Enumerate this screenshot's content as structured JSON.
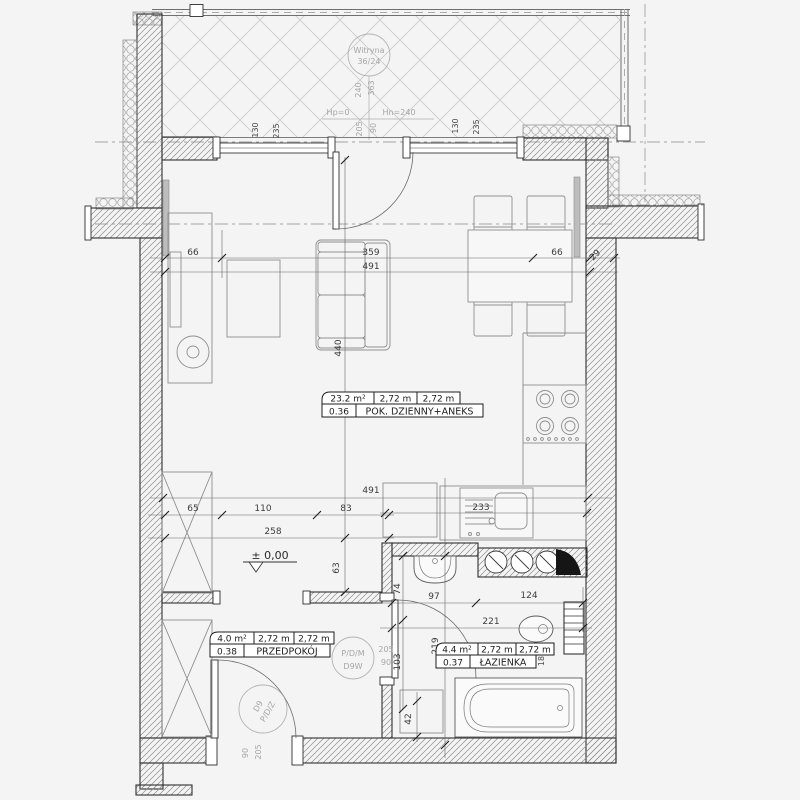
{
  "plan_type": "apartment-floor-plan",
  "balcony": {
    "glazing_label": "Witryna",
    "glazing_size": "36/24",
    "dim_240": "240",
    "dim_363": "363",
    "hp_label": "Hp=0",
    "hn_label": "Hn=240",
    "door_height": "205",
    "door_width": "90",
    "window1_dim_a": "130",
    "window1_dim_b": "235",
    "window2_dim_a": "130",
    "window2_dim_b": "235"
  },
  "rooms": {
    "living": {
      "number": "0.36",
      "name": "POK. DZIENNY+ANEKS",
      "area": "23.2 m²",
      "dim_w": "2,72 m",
      "dim_h": "2,72 m"
    },
    "hallway": {
      "number": "0.38",
      "name": "PRZEDPOKÓJ",
      "area": "4.0 m²",
      "dim_w": "2,72 m",
      "dim_h": "2,72 m"
    },
    "bathroom": {
      "number": "0.37",
      "name": "ŁAZIENKA",
      "area": "4.4 m²",
      "dim_w": "2,72 m",
      "dim_h": "2,72 m",
      "side_note": "18"
    }
  },
  "dims": {
    "top_left_66": "66",
    "top_359": "359",
    "top_right_66": "66",
    "top_29": "29",
    "top_total_491": "491",
    "depth_440": "440",
    "passage_63": "63",
    "low_65": "65",
    "low_110": "110",
    "low_83": "83",
    "low_total_258": "258",
    "kitchen_491": "491",
    "sink_233": "233",
    "bath_74": "74",
    "bath_97": "97",
    "bath_124": "124",
    "bath_221": "221",
    "bath_219": "219",
    "bath_103": "103",
    "bath_42": "42",
    "level": "± 0,00"
  },
  "doors": {
    "entrance_code": "D9",
    "entrance_type": "P/D/Z",
    "entrance_w": "90",
    "entrance_h": "205",
    "bath_type": "P/D/M",
    "bath_code": "D9W",
    "bath_w": "90",
    "bath_h": "205"
  },
  "colors": {
    "wall_line": "#2f2f2f",
    "hatch": "#9a9a9a",
    "balcony_hatch": "#c9c9c9",
    "dim_text": "#3c3c3c",
    "gray_note": "#a6a6a6",
    "radiator": "#bdbdbd",
    "background": "#f4f4f4"
  }
}
